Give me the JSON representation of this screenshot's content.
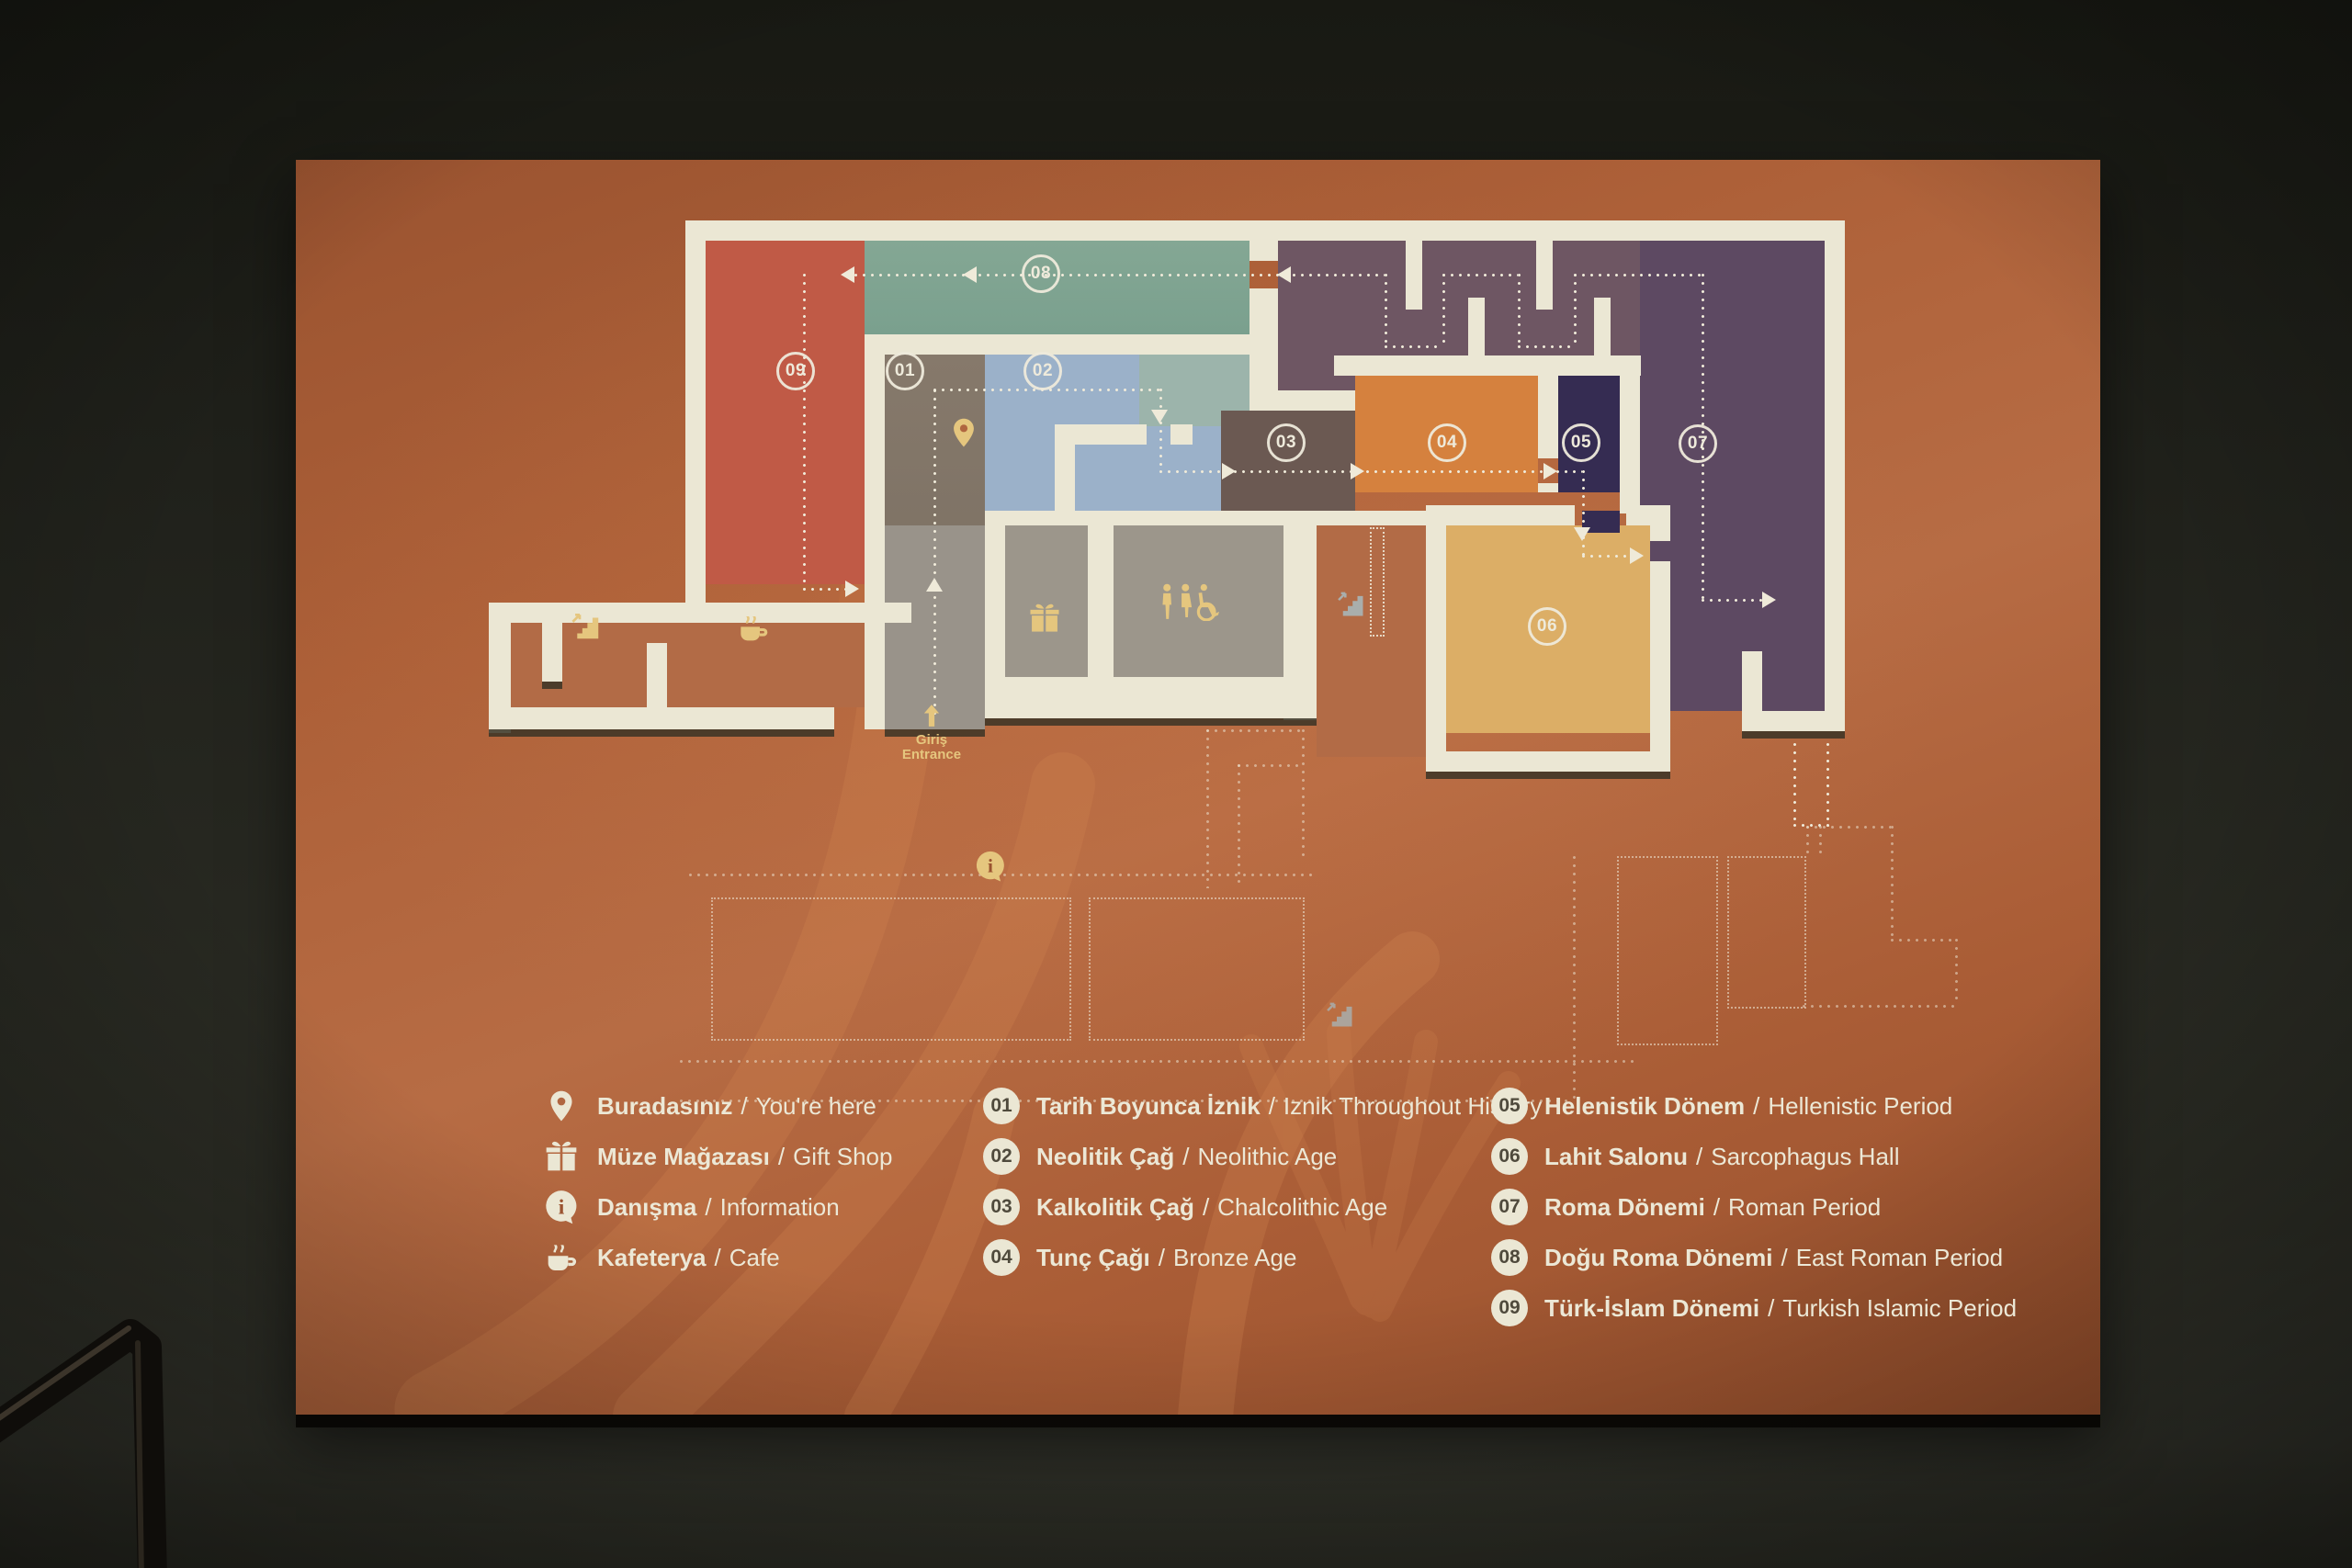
{
  "colors": {
    "wall": "#ebe7d4",
    "dot": "#efead9",
    "text": "#ece8d6",
    "gold": "#e5c67e",
    "board": "#b06640",
    "boardDark": "#9a5330",
    "room01": "#86796b",
    "room02": "#9bb1c9",
    "room02b": "#9cb4ab",
    "room03": "#6b5952",
    "room04": "#d5813e",
    "room05": "#352c52",
    "room06": "#dcae66",
    "room07": "#5d4962",
    "room08": "#84a794",
    "room09": "#c05a46",
    "maze": "#6e5663",
    "grayRoom": "#9c968b",
    "lobby": "#99938a",
    "rust": "#b26b46"
  },
  "sign": {
    "separator": "/",
    "entrance": {
      "tr": "Giriş",
      "en": "Entrance"
    },
    "facilities": [
      {
        "icon": "location-pin",
        "tr": "Buradasınız",
        "en": "You're here"
      },
      {
        "icon": "gift",
        "tr": "Müze Mağazası",
        "en": "Gift Shop"
      },
      {
        "icon": "information",
        "tr": "Danışma",
        "en": "Information"
      },
      {
        "icon": "cafe",
        "tr": "Kafeterya",
        "en": "Cafe"
      }
    ],
    "rooms": [
      {
        "num": "01",
        "tr": "Tarih Boyunca İznik",
        "en": "Iznik Throughout History"
      },
      {
        "num": "02",
        "tr": "Neolitik Çağ",
        "en": "Neolithic Age"
      },
      {
        "num": "03",
        "tr": "Kalkolitik Çağ",
        "en": "Chalcolithic Age"
      },
      {
        "num": "04",
        "tr": "Tunç Çağı",
        "en": "Bronze Age"
      },
      {
        "num": "05",
        "tr": "Helenistik Dönem",
        "en": "Hellenistic Period"
      },
      {
        "num": "06",
        "tr": "Lahit Salonu",
        "en": "Sarcophagus Hall"
      },
      {
        "num": "07",
        "tr": "Roma Dönemi",
        "en": "Roman Period"
      },
      {
        "num": "08",
        "tr": "Doğu Roma Dönemi",
        "en": "East Roman Period"
      },
      {
        "num": "09",
        "tr": "Türk-İslam Dönemi",
        "en": "Turkish Islamic Period"
      }
    ]
  }
}
